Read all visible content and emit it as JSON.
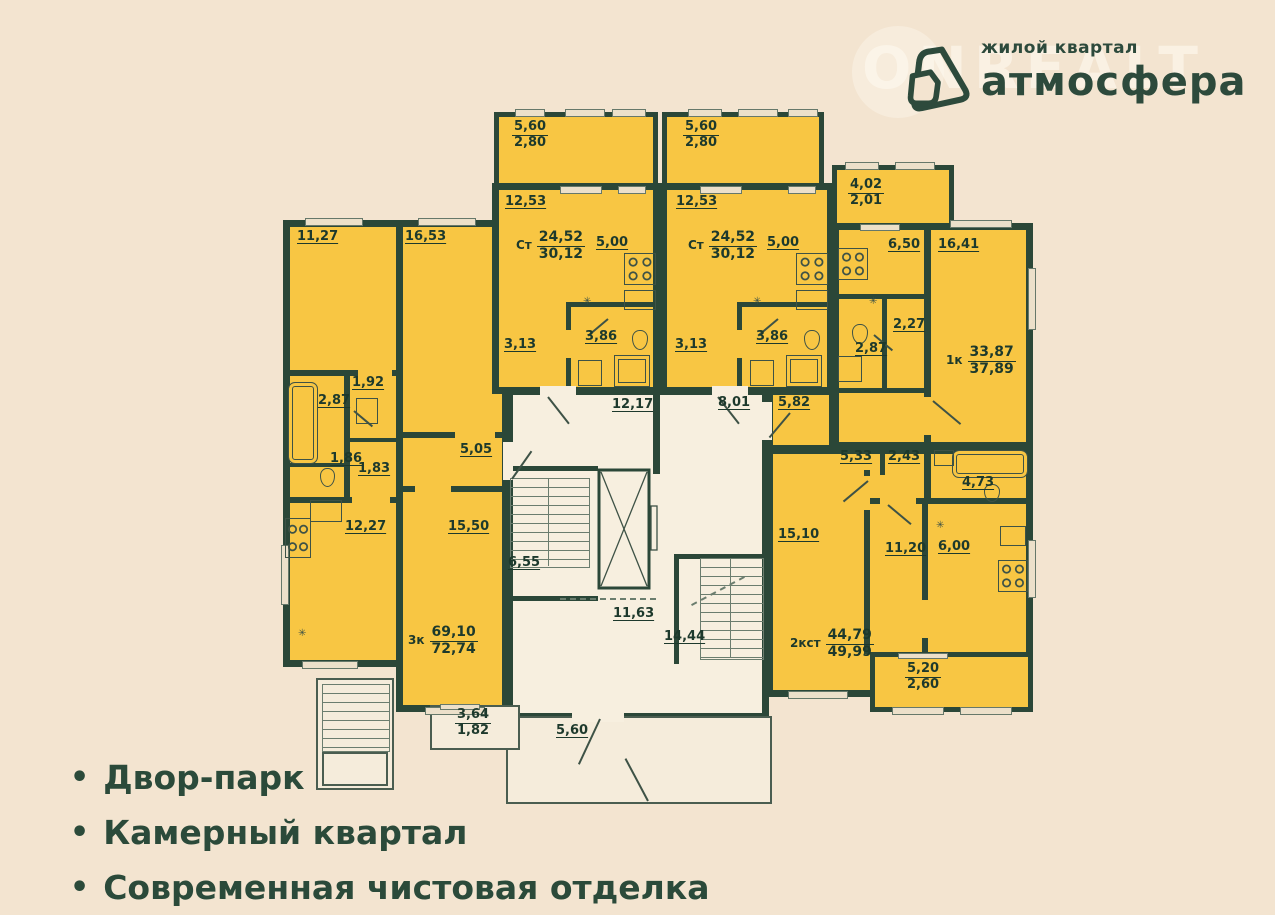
{
  "watermark": "ONREALT",
  "logo": {
    "tagline": "жилой квартал",
    "brand": "атмосфера"
  },
  "features": {
    "bullet": "•",
    "item1": "Двор-парк",
    "item2": "Камерный квартал",
    "item3": "Современная чистовая отделка"
  },
  "icons": {
    "vent": "✳"
  },
  "plan": {
    "apartments": {
      "three_room": {
        "type": "3к",
        "living": "69,10",
        "total": "72,74",
        "rooms": {
          "bedroom1": "11,27",
          "bedroom2": "16,53",
          "bath": "2,87",
          "hall": "1,92",
          "wc": "1,86",
          "hall2": "1,83",
          "corridor": "5,05",
          "kitchen": "12,27",
          "living_room": "15,50",
          "balcony_a": "3,64",
          "balcony_b": "1,82"
        }
      },
      "studio_left": {
        "type": "Ст",
        "living": "24,52",
        "total": "30,12",
        "rooms": {
          "balcony_a": "5,60",
          "balcony_b": "2,80",
          "room": "12,53",
          "kitchen": "5,00",
          "hall": "3,13",
          "bath": "3,86"
        }
      },
      "studio_right": {
        "type": "Ст",
        "living": "24,52",
        "total": "30,12",
        "rooms": {
          "balcony_a": "5,60",
          "balcony_b": "2,80",
          "room": "12,53",
          "kitchen": "5,00",
          "hall": "3,13",
          "bath": "3,86"
        }
      },
      "one_room": {
        "type": "1к",
        "living": "33,87",
        "total": "37,89",
        "rooms": {
          "balcony_a": "4,02",
          "balcony_b": "2,01",
          "kitchen": "6,50",
          "room": "16,41",
          "hall": "2,27",
          "bath": "2,87"
        }
      },
      "two_room_studio": {
        "type": "2кст",
        "living": "44,79",
        "total": "49,99",
        "rooms": {
          "hall_entry": "5,82",
          "hall1": "5,33",
          "hall2": "2,43",
          "bath": "4,73",
          "room1": "15,10",
          "room2": "11,20",
          "kitchen": "6,00",
          "balcony_a": "5,20",
          "balcony_b": "2,60"
        }
      }
    },
    "common": {
      "corridor_left": "12,17",
      "corridor_right": "8,01",
      "stairs_left": "6,55",
      "lobby": "11,63",
      "stairs_right": "14,44",
      "vestibule": "5,60"
    }
  }
}
